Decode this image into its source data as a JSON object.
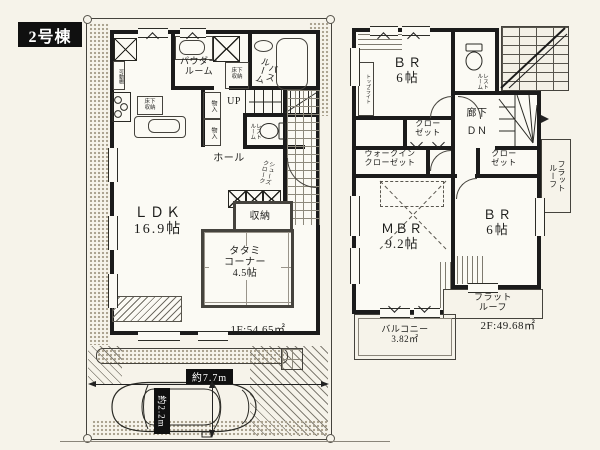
{
  "title": "2号棟",
  "colors": {
    "wall": "#1b1b1b",
    "paper": "#f6f3ea",
    "label_bg": "#101010",
    "label_text": "#ffffff"
  },
  "floor1": {
    "area": "1F:54.65㎡",
    "ldk": "ＬＤＫ\n16.9帖",
    "tatami": "タタミ\nコーナー\n4.5帖",
    "powder": "パウダー\nルーム",
    "bath": "バス\nルーム",
    "restroom": "レスト\nルーム",
    "stairs_up": "UP",
    "hall": "ホール",
    "storage": "収納",
    "closet_a": "物入",
    "closet_b": "物入",
    "movable_shelf": "可動棚",
    "underfloor_kitchen": "床下\n収納",
    "underfloor_powder": "床下\n収納",
    "shoe_cloak": "シューズ\nクローク"
  },
  "floor2": {
    "area": "2F:49.68㎡",
    "bedroom_top": "ＢＲ\n6帖",
    "bedroom_right": "ＢＲ\n6帖",
    "master_bedroom": "ＭＢＲ\n9.2帖",
    "walk_in_closet": "ウォークイン\nクローゼット",
    "closet_top": "クロー\nゼット",
    "closet_right": "クロー\nゼット",
    "restroom": "レスト\nルーム",
    "corridor": "廊下",
    "stairs_down": "ＤＮ",
    "skylight": "トップライト",
    "flat_roof_side": "フラット\nルーフ",
    "flat_roof_bottom": "フラット\nルーフ",
    "balcony": "バルコニー\n3.82㎡"
  },
  "parking": {
    "width_label": "約7.7m",
    "depth_label": "約2.2m"
  }
}
